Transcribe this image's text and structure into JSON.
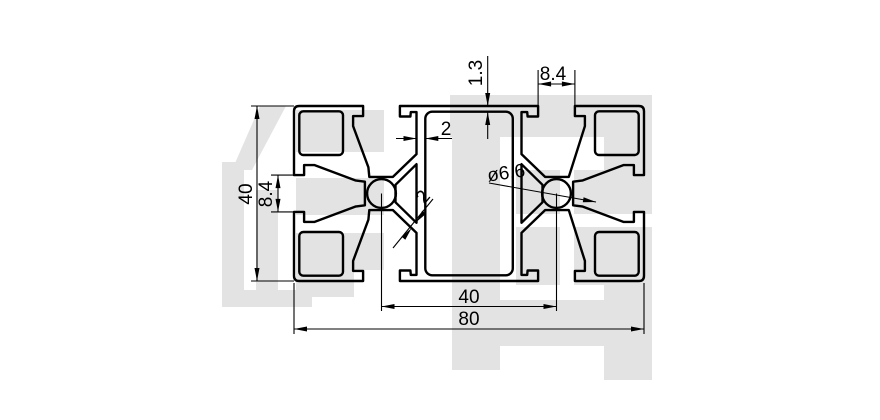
{
  "drawing": {
    "type": "aluminum-extrusion-profile-cross-section",
    "line_color": "#000000",
    "watermark": {
      "text": "信牌",
      "color": "#e3e3e3"
    },
    "dimensions": {
      "overall_height": "40",
      "side_slot_width": "8.4",
      "top_wall_thickness": "1.3",
      "web_thickness": "2",
      "top_slot_width": "8.4",
      "hole_diameter": "ø6.6",
      "diagonal_wall_thickness": "2",
      "hole_pitch": "40",
      "overall_width": "80"
    }
  }
}
